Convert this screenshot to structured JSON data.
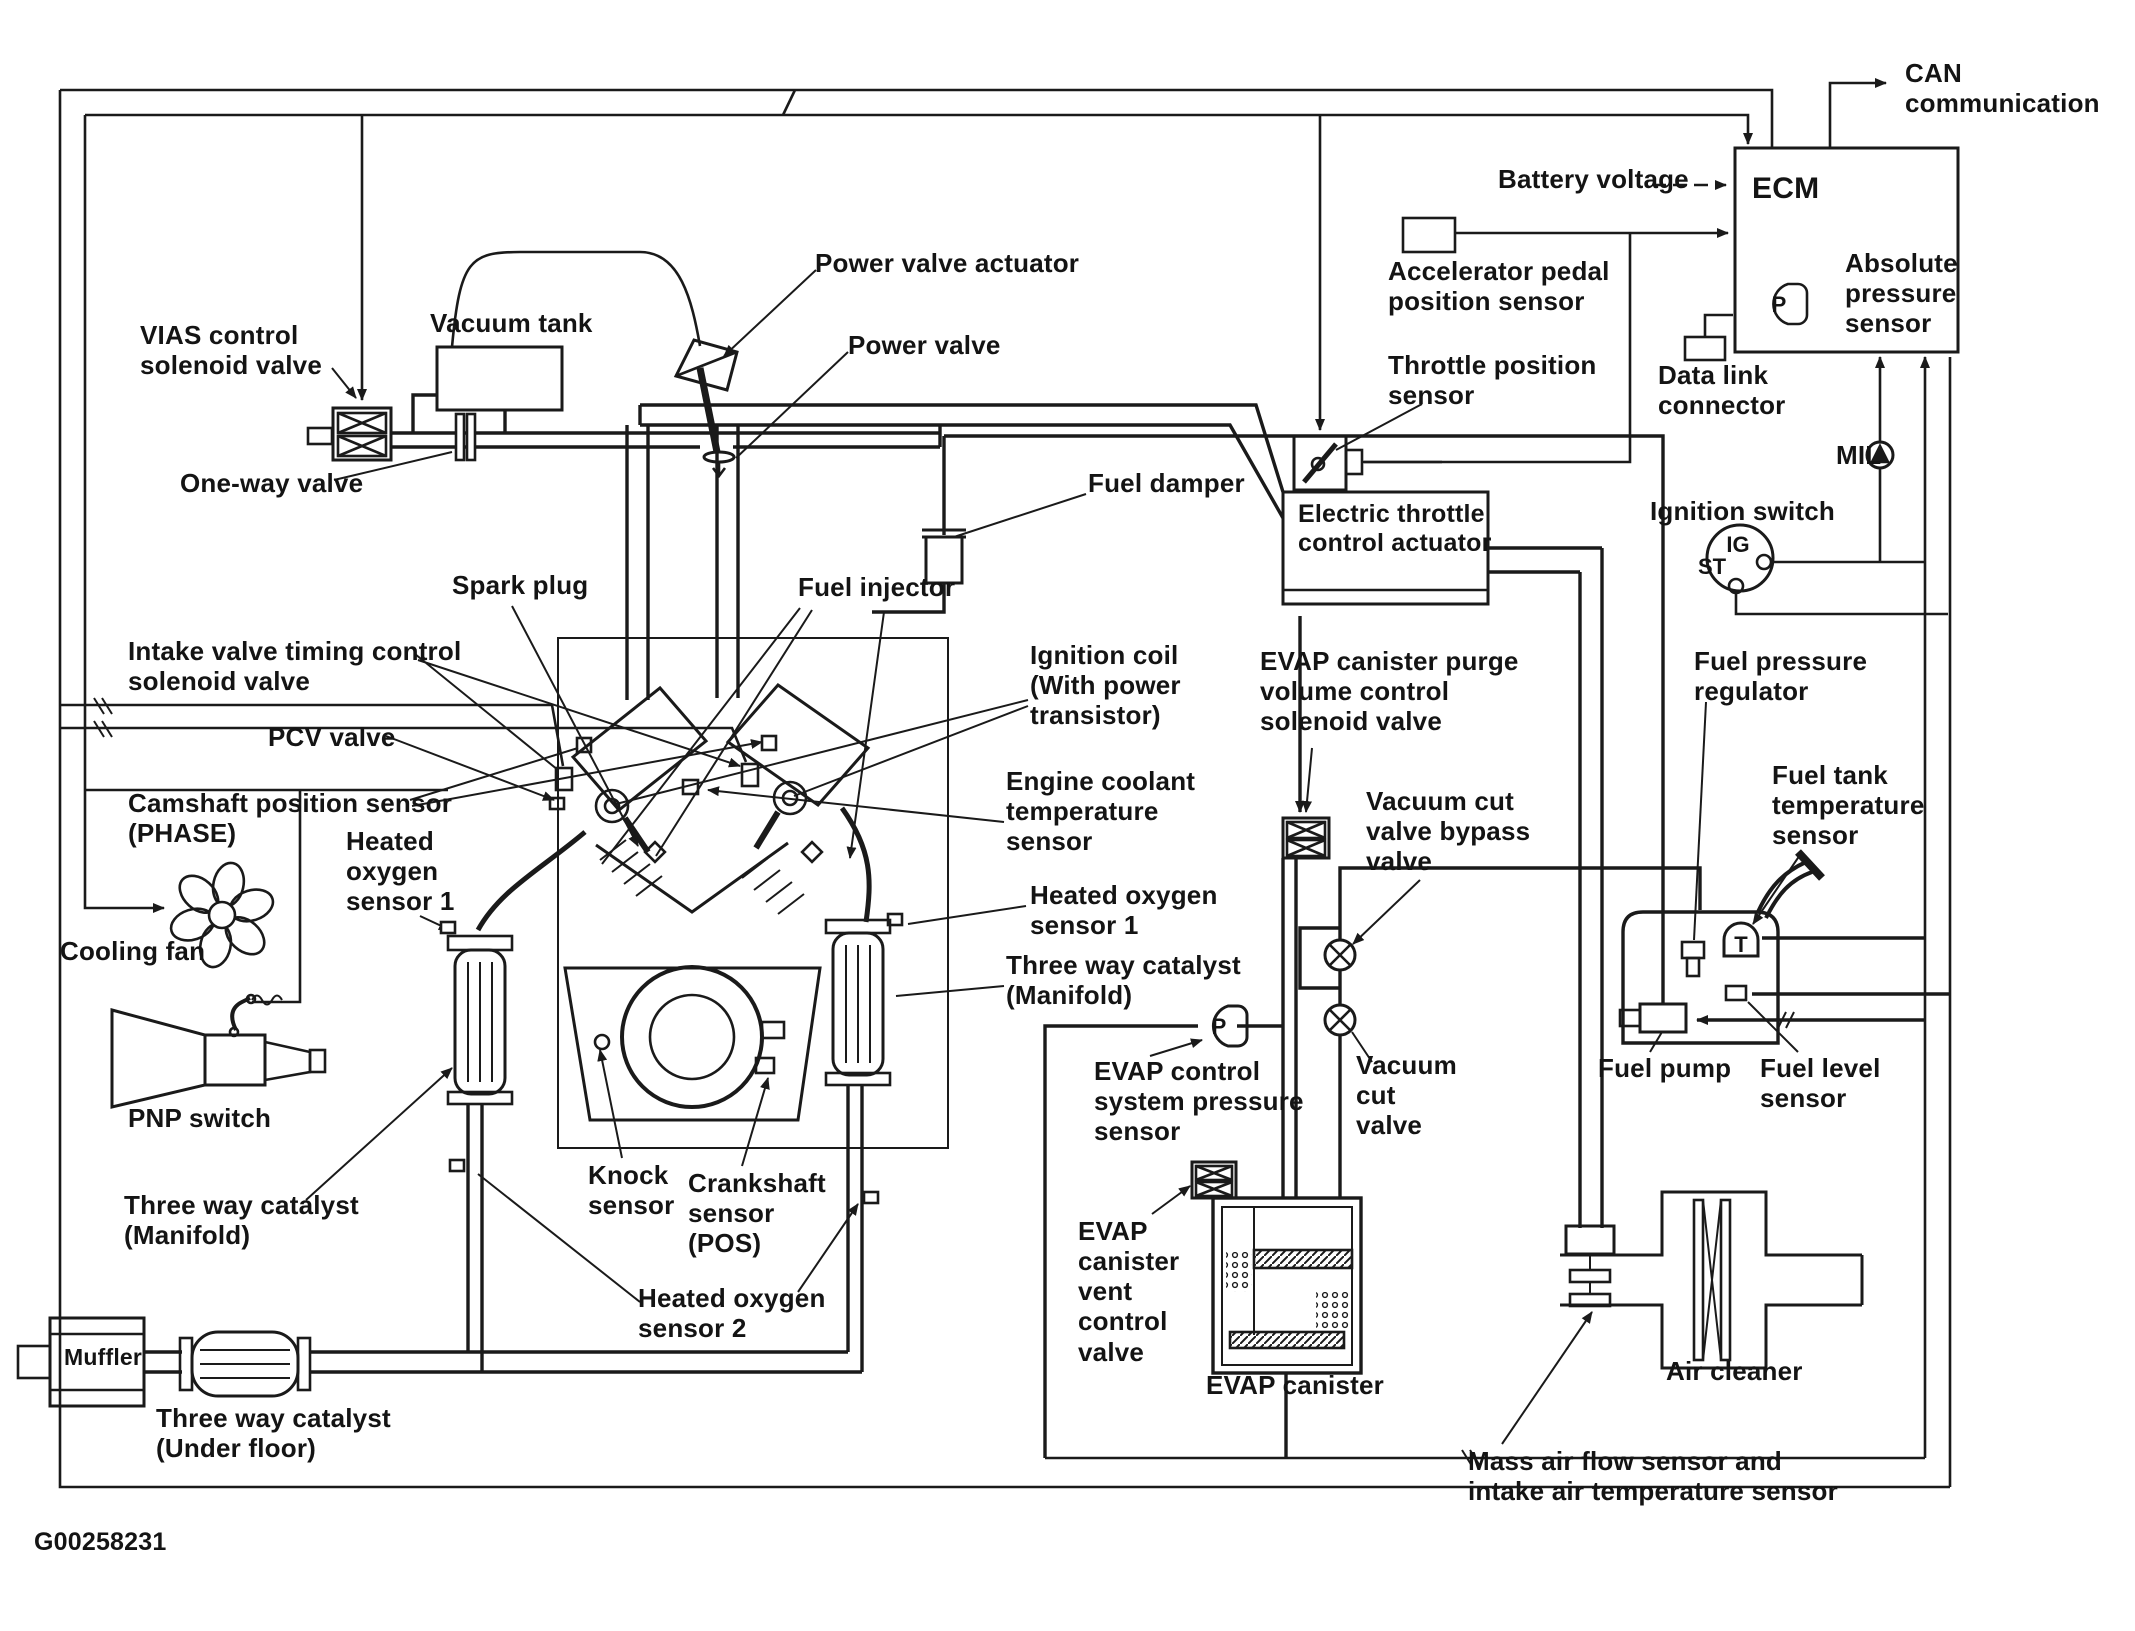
{
  "diagram": {
    "title": "Engine vacuum hose and sensor layout diagram",
    "figure_id": "G00258231",
    "ink_color": "#1a1a1a",
    "paper_color": "#ffffff"
  },
  "glyphs": {
    "p_ecm": "P",
    "p_evap": "P",
    "t_tank": "T",
    "ig": "IG",
    "st": "ST"
  },
  "labels": [
    {
      "id": "vias",
      "text": "VIAS control\nsolenoid valve",
      "x": 140,
      "y": 320
    },
    {
      "id": "vacuum-tank",
      "text": "Vacuum tank",
      "x": 430,
      "y": 308
    },
    {
      "id": "one-way-valve",
      "text": "One-way valve",
      "x": 180,
      "y": 468
    },
    {
      "id": "power-valve-actuator",
      "text": "Power valve actuator",
      "x": 815,
      "y": 248
    },
    {
      "id": "power-valve",
      "text": "Power valve",
      "x": 848,
      "y": 330
    },
    {
      "id": "fuel-damper",
      "text": "Fuel damper",
      "x": 1088,
      "y": 468
    },
    {
      "id": "battery-voltage",
      "text": "Battery voltage",
      "x": 1498,
      "y": 164
    },
    {
      "id": "ecm",
      "text": "ECM",
      "x": 1752,
      "y": 172,
      "size": 30
    },
    {
      "id": "can-communication",
      "text": "CAN\ncommunication",
      "x": 1905,
      "y": 58
    },
    {
      "id": "accelerator-pedal",
      "text": "Accelerator pedal\nposition sensor",
      "x": 1388,
      "y": 256
    },
    {
      "id": "absolute-pressure",
      "text": "Absolute\npressure\nsensor",
      "x": 1845,
      "y": 248
    },
    {
      "id": "data-link-connector",
      "text": "Data link\nconnector",
      "x": 1658,
      "y": 360
    },
    {
      "id": "throttle-position",
      "text": "Throttle position\nsensor",
      "x": 1388,
      "y": 350
    },
    {
      "id": "mil",
      "text": "MIL",
      "x": 1836,
      "y": 440
    },
    {
      "id": "ignition-switch",
      "text": "Ignition switch",
      "x": 1650,
      "y": 496
    },
    {
      "id": "electric-throttle",
      "text": "Electric throttle\ncontrol actuator",
      "x": 1298,
      "y": 500,
      "size": 25
    },
    {
      "id": "spark-plug",
      "text": "Spark plug",
      "x": 452,
      "y": 570
    },
    {
      "id": "fuel-injector",
      "text": "Fuel injector",
      "x": 798,
      "y": 572
    },
    {
      "id": "ignition-coil",
      "text": "Ignition coil\n(With power\ntransistor)",
      "x": 1030,
      "y": 640
    },
    {
      "id": "intake-valve-timing",
      "text": "Intake valve timing control\nsolenoid valve",
      "x": 128,
      "y": 636
    },
    {
      "id": "evap-purge",
      "text": "EVAP canister purge\nvolume control\nsolenoid valve",
      "x": 1260,
      "y": 646
    },
    {
      "id": "fuel-pressure-regulator",
      "text": "Fuel pressure\nregulator",
      "x": 1694,
      "y": 646
    },
    {
      "id": "pcv-valve",
      "text": "PCV valve",
      "x": 268,
      "y": 722
    },
    {
      "id": "vacuum-cut-bypass",
      "text": "Vacuum cut\nvalve bypass\nvalve",
      "x": 1366,
      "y": 786
    },
    {
      "id": "fuel-tank-temp",
      "text": "Fuel tank\ntemperature\nsensor",
      "x": 1772,
      "y": 760
    },
    {
      "id": "camshaft-position",
      "text": "Camshaft position sensor\n(PHASE)",
      "x": 128,
      "y": 788
    },
    {
      "id": "engine-coolant-temp",
      "text": "Engine coolant\ntemperature\nsensor",
      "x": 1006,
      "y": 766
    },
    {
      "id": "ho2s1-left",
      "text": "Heated\noxygen\nsensor 1",
      "x": 346,
      "y": 826
    },
    {
      "id": "ho2s1-right",
      "text": "Heated oxygen\nsensor 1",
      "x": 1030,
      "y": 880
    },
    {
      "id": "twc-manifold-right",
      "text": "Three way catalyst\n(Manifold)",
      "x": 1006,
      "y": 950
    },
    {
      "id": "cooling-fan",
      "text": "Cooling fan",
      "x": 60,
      "y": 936
    },
    {
      "id": "evap-pressure-sensor",
      "text": "EVAP control\nsystem pressure\nsensor",
      "x": 1094,
      "y": 1056
    },
    {
      "id": "vacuum-cut-valve",
      "text": "Vacuum\ncut\nvalve",
      "x": 1356,
      "y": 1050
    },
    {
      "id": "fuel-pump",
      "text": "Fuel pump",
      "x": 1598,
      "y": 1053
    },
    {
      "id": "fuel-level-sensor",
      "text": "Fuel level\nsensor",
      "x": 1760,
      "y": 1053
    },
    {
      "id": "pnp-switch",
      "text": "PNP switch",
      "x": 128,
      "y": 1103
    },
    {
      "id": "twc-manifold-left",
      "text": "Three way catalyst\n(Manifold)",
      "x": 124,
      "y": 1190
    },
    {
      "id": "knock-sensor",
      "text": "Knock\nsensor",
      "x": 588,
      "y": 1160
    },
    {
      "id": "crankshaft-sensor",
      "text": "Crankshaft\nsensor\n(POS)",
      "x": 688,
      "y": 1168
    },
    {
      "id": "evap-vent-valve",
      "text": "EVAP\ncanister\nvent\ncontrol\nvalve",
      "x": 1078,
      "y": 1216
    },
    {
      "id": "ho2s2",
      "text": "Heated oxygen\nsensor 2",
      "x": 638,
      "y": 1283
    },
    {
      "id": "evap-canister",
      "text": "EVAP canister",
      "x": 1206,
      "y": 1370
    },
    {
      "id": "muffler",
      "text": "Muffler",
      "x": 64,
      "y": 1344,
      "size": 23
    },
    {
      "id": "twc-under-floor",
      "text": "Three way catalyst\n(Under floor)",
      "x": 156,
      "y": 1403
    },
    {
      "id": "air-cleaner",
      "text": "Air cleaner",
      "x": 1666,
      "y": 1356
    },
    {
      "id": "maf-sensor",
      "text": "Mass air flow sensor and\nintake air temperature sensor",
      "x": 1468,
      "y": 1446
    },
    {
      "id": "figure-id",
      "text": "G00258231",
      "x": 34,
      "y": 1528,
      "size": 25
    }
  ]
}
